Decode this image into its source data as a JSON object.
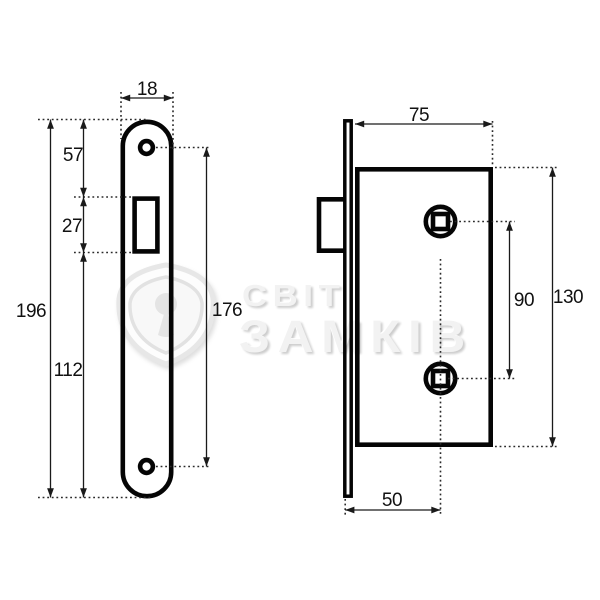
{
  "watermark": {
    "brand_line1": "СВІТ",
    "brand_line2": "ЗАМКІВ",
    "logo": "shield-keyhole"
  },
  "drawing": {
    "type": "technical-drawing",
    "subject": "mortise-lock",
    "dimensions": {
      "faceplate_width": "18",
      "top_to_latch_cutout": "57",
      "latch_cutout_height": "27",
      "latch_cutout_to_bottom": "112",
      "faceplate_length": "196",
      "screw_hole_spacing": "176",
      "body_depth": "75",
      "spindle_hole_spacing": "90",
      "body_height": "130",
      "backset": "50"
    },
    "colors": {
      "line": "#050505",
      "dimension_line": "#1a1a1a",
      "watermark_gray": "#f2f2f2",
      "background": "#ffffff"
    }
  }
}
